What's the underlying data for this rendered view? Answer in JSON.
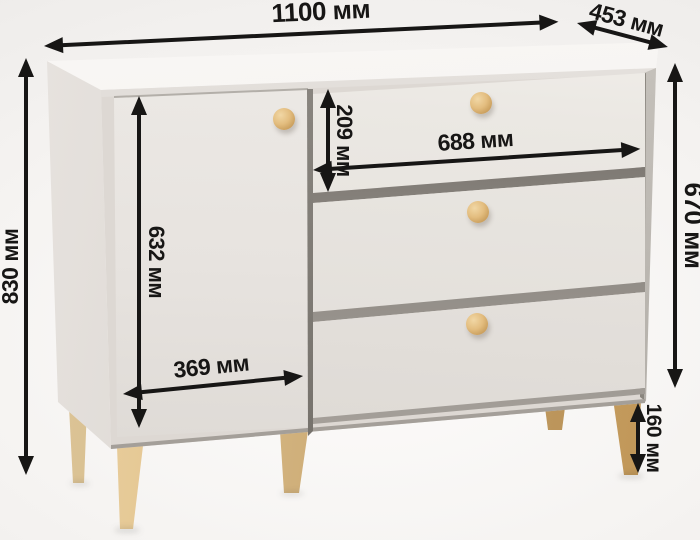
{
  "diagram": {
    "subject": "chest-of-drawers",
    "unit": "мм",
    "dimensions": {
      "top_width": "1100 мм",
      "top_depth": "453 мм",
      "total_height": "830 мм",
      "door_height": "632 мм",
      "top_drawer_height": "209 мм",
      "drawer_width": "688 мм",
      "body_height": "670 мм",
      "door_width": "369 мм",
      "leg_height": "160 мм"
    },
    "colors": {
      "annotation": "#171615",
      "body_front": "#e6e2dd",
      "body_side": "#d8d3ce",
      "knob_wood": "#e3bd7f",
      "leg_wood": "#cda466",
      "background": "#f5f3f1"
    }
  }
}
